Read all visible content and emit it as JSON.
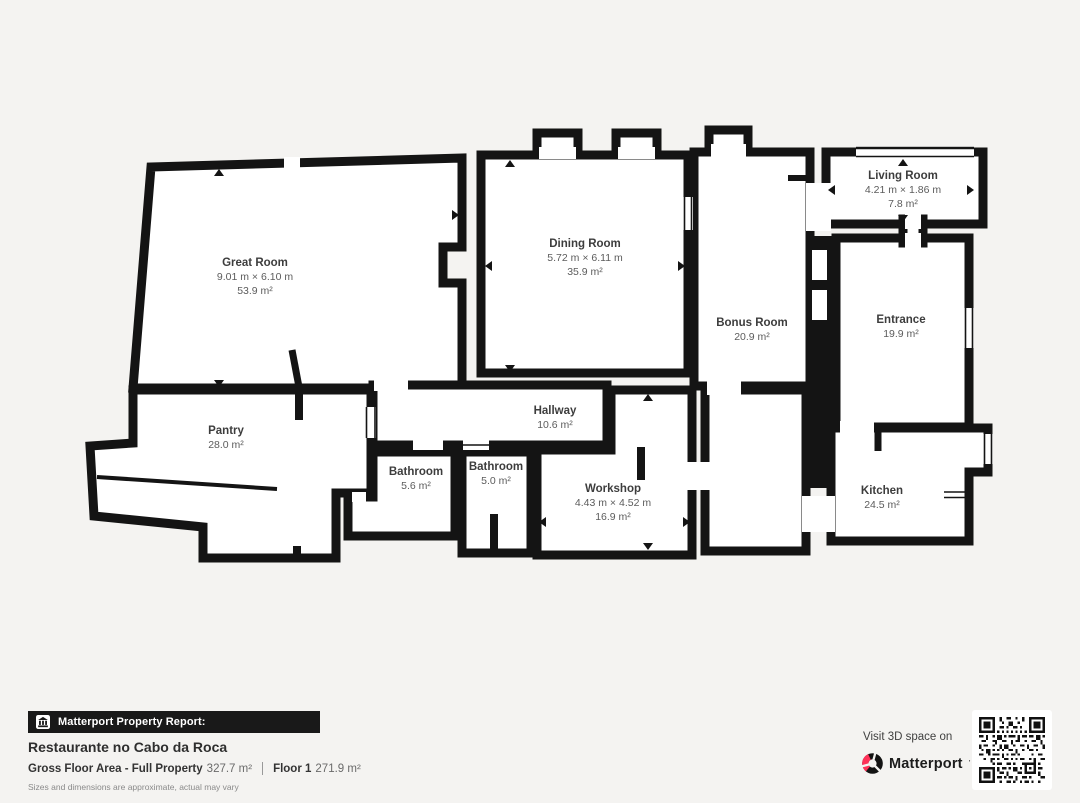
{
  "plan": {
    "rooms": [
      {
        "name": "Great Room",
        "dimensions": "9.01 m × 6.10 m",
        "area": "53.9 m²"
      },
      {
        "name": "Dining Room",
        "dimensions": "5.72 m × 6.11 m",
        "area": "35.9 m²"
      },
      {
        "name": "Living Room",
        "dimensions": "4.21 m × 1.86 m",
        "area": "7.8 m²"
      },
      {
        "name": "Bonus Room",
        "dimensions": "",
        "area": "20.9 m²"
      },
      {
        "name": "Entrance",
        "dimensions": "",
        "area": "19.9 m²"
      },
      {
        "name": "Pantry",
        "dimensions": "",
        "area": "28.0 m²"
      },
      {
        "name": "Hallway",
        "dimensions": "",
        "area": "10.6 m²"
      },
      {
        "name": "Bathroom",
        "dimensions": "",
        "area": "5.6 m²"
      },
      {
        "name": "Bathroom",
        "dimensions": "",
        "area": "5.0 m²"
      },
      {
        "name": "Workshop",
        "dimensions": "4.43 m × 4.52 m",
        "area": "16.9 m²"
      },
      {
        "name": "Kitchen",
        "dimensions": "",
        "area": "24.5 m²"
      }
    ]
  },
  "footer": {
    "report_bar_label": "Matterport Property Report:",
    "property_title": "Restaurante no Cabo da Roca",
    "stats": [
      {
        "label": "Gross Floor Area - Full Property",
        "value": "327.7 m²"
      },
      {
        "label": "Floor 1",
        "value": "271.9 m²"
      }
    ],
    "disclaimer": "Sizes and dimensions are approximate, actual may vary"
  },
  "cta": {
    "visit_text": "Visit 3D space on",
    "brand": "Matterport",
    "trademark": "’"
  },
  "colors": {
    "wall": "#141414",
    "background": "#f4f3f1",
    "room_fill": "#ffffff",
    "brand_red": "#ff3158",
    "bar_background": "#191919"
  }
}
